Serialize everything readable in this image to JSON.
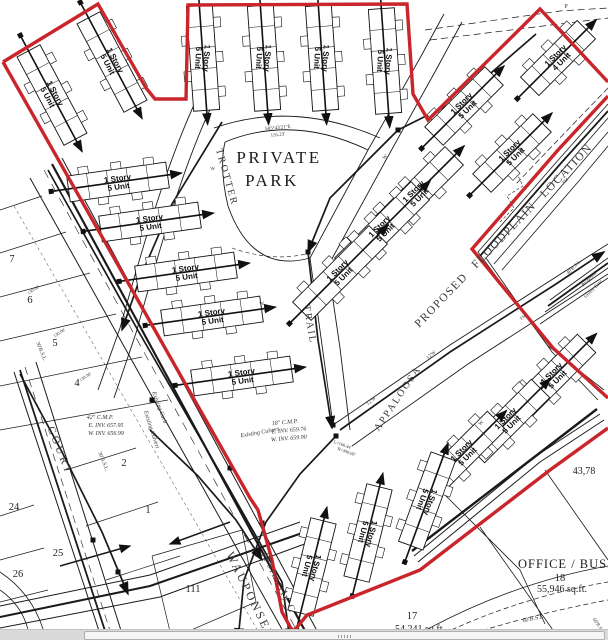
{
  "colors": {
    "boundary_red": "#c9252b",
    "ink": "#1a1a1a"
  },
  "park": {
    "line1": "PRIVATE",
    "line2": "PARK"
  },
  "office": {
    "name": "OFFICE / BUSIN",
    "lot_number": "18",
    "area": "55,946 sq.ft."
  },
  "lot17": {
    "number": "17",
    "area": "54,241 sq.ft."
  },
  "edge_area": "43,78",
  "building_labels": {
    "5": [
      "1 Story",
      "5 Unit"
    ],
    "4": [
      "1 Story",
      "4 Unit"
    ]
  },
  "buildings": [
    {
      "x": 52,
      "y": 95,
      "rot": 62,
      "lrot": 62,
      "len": 100
    },
    {
      "x": 112,
      "y": 62,
      "rot": 62,
      "lrot": 62,
      "len": 100
    },
    {
      "x": 203,
      "y": 58,
      "rot": 86,
      "lrot": 93,
      "len": 105
    },
    {
      "x": 264,
      "y": 58,
      "rot": 86,
      "lrot": 93,
      "len": 105
    },
    {
      "x": 322,
      "y": 58,
      "rot": 86,
      "lrot": 93,
      "len": 105
    },
    {
      "x": 385,
      "y": 61,
      "rot": 86,
      "lrot": 93,
      "len": 105
    },
    {
      "x": 118,
      "y": 182,
      "rot": -8,
      "lrot": -8,
      "len": 100
    },
    {
      "x": 150,
      "y": 222,
      "rot": -8,
      "lrot": -8,
      "len": 100
    },
    {
      "x": 186,
      "y": 272,
      "rot": -8,
      "lrot": -8,
      "len": 100
    },
    {
      "x": 212,
      "y": 316,
      "rot": -8,
      "lrot": -8,
      "len": 100
    },
    {
      "x": 242,
      "y": 376,
      "rot": -8,
      "lrot": -8,
      "len": 100
    },
    {
      "x": 416,
      "y": 194,
      "rot": -45,
      "lrot": -45,
      "len": 108
    },
    {
      "x": 382,
      "y": 229,
      "rot": -45,
      "lrot": -45,
      "len": 108
    },
    {
      "x": 340,
      "y": 273,
      "rot": -45,
      "lrot": -45,
      "len": 108
    },
    {
      "x": 558,
      "y": 58,
      "rot": -45,
      "lrot": -45,
      "len": 80,
      "type": "4"
    },
    {
      "x": 464,
      "y": 106,
      "rot": -45,
      "lrot": -45,
      "len": 85
    },
    {
      "x": 512,
      "y": 153,
      "rot": -45,
      "lrot": -45,
      "len": 85
    },
    {
      "x": 554,
      "y": 376,
      "rot": -45,
      "lrot": -45,
      "len": 92
    },
    {
      "x": 508,
      "y": 421,
      "rot": -45,
      "lrot": -45,
      "len": 92
    },
    {
      "x": 464,
      "y": 453,
      "rot": -45,
      "lrot": -45,
      "len": 92
    },
    {
      "x": 312,
      "y": 567,
      "rot": -76,
      "lrot": 104,
      "len": 95
    },
    {
      "x": 368,
      "y": 533,
      "rot": -76,
      "lrot": 104,
      "len": 95
    },
    {
      "x": 427,
      "y": 501,
      "rot": -70,
      "lrot": 110,
      "len": 95
    }
  ],
  "street_names": [
    {
      "name": "COURT",
      "x": 57,
      "y": 452,
      "rot": 68,
      "size": 11,
      "ls": 3
    },
    {
      "name": "WAUPONSEE",
      "x": 247,
      "y": 597,
      "rot": 64,
      "size": 12,
      "ls": 2.5
    },
    {
      "name": "(Formerly C",
      "x": 276,
      "y": 584,
      "rot": 64,
      "size": 10,
      "ls": 1.5
    },
    {
      "name": "TROTTER",
      "x": 224,
      "y": 178,
      "rot": 74,
      "size": 10,
      "ls": 2
    },
    {
      "name": "TRAIL",
      "x": 307,
      "y": 325,
      "rot": 80,
      "size": 10,
      "ls": 2
    },
    {
      "name": "APPALOOSA",
      "x": 400,
      "y": 400,
      "rot": -56,
      "size": 10,
      "ls": 2
    },
    {
      "name": "PROPOSED FLOODPLAIN LOCATION",
      "x": 506,
      "y": 238,
      "rot": -46,
      "size": 11.5,
      "ls": 1.5,
      "ws": 7
    }
  ],
  "lot_numbers": [
    {
      "n": "7",
      "x": 12,
      "y": 262
    },
    {
      "n": "6",
      "x": 30,
      "y": 303
    },
    {
      "n": "5",
      "x": 55,
      "y": 346
    },
    {
      "n": "4",
      "x": 77,
      "y": 386
    },
    {
      "n": "2",
      "x": 124,
      "y": 466
    },
    {
      "n": "1",
      "x": 148,
      "y": 513
    },
    {
      "n": "24",
      "x": 14,
      "y": 510
    },
    {
      "n": "25",
      "x": 58,
      "y": 556
    },
    {
      "n": "26",
      "x": 18,
      "y": 577
    },
    {
      "n": "111",
      "x": 193,
      "y": 592
    },
    {
      "n": "110",
      "x": 207,
      "y": 638
    }
  ],
  "annotations": [
    {
      "t": "S85°43'21\"E",
      "x": 278,
      "y": 129,
      "rot": -5,
      "s": 5
    },
    {
      "t": "155.23'",
      "x": 278,
      "y": 136,
      "rot": -5,
      "s": 5
    },
    {
      "t": "42\" C.M.P.",
      "x": 100,
      "y": 419,
      "rot": 0,
      "s": 6,
      "i": 1
    },
    {
      "t": "E. INV. 657.95",
      "x": 106,
      "y": 427,
      "rot": 0,
      "s": 6,
      "i": 1
    },
    {
      "t": "W. INV. 656.99",
      "x": 106,
      "y": 435,
      "rot": 0,
      "s": 6,
      "i": 1
    },
    {
      "t": "18\" C.M.P.",
      "x": 285,
      "y": 424,
      "rot": -5,
      "s": 6,
      "i": 1
    },
    {
      "t": "E. INV. 659.76",
      "x": 289,
      "y": 432,
      "rot": -5,
      "s": 6,
      "i": 1
    },
    {
      "t": "W. INV. 659.90",
      "x": 289,
      "y": 440,
      "rot": -5,
      "s": 6,
      "i": 1
    },
    {
      "t": "Existing Culvert",
      "x": 150,
      "y": 430,
      "rot": 72,
      "s": 6,
      "i": 1
    },
    {
      "t": "Existing Culvert",
      "x": 260,
      "y": 434,
      "rot": -10,
      "s": 6,
      "i": 1
    },
    {
      "t": "Existing Curb",
      "x": 158,
      "y": 408,
      "rot": 70,
      "s": 6,
      "i": 1
    },
    {
      "t": "30'B.S.L.",
      "x": 40,
      "y": 352,
      "rot": 68,
      "s": 5.5
    },
    {
      "t": "30'B.S.L.",
      "x": 102,
      "y": 462,
      "rot": 68,
      "s": 5.5
    },
    {
      "t": "40'B.S.L.",
      "x": 575,
      "y": 268,
      "rot": -45,
      "s": 5
    },
    {
      "t": "60'B.S.L.",
      "x": 534,
      "y": 620,
      "rot": -12,
      "s": 6
    },
    {
      "t": "60'B.S.L.",
      "x": 598,
      "y": 627,
      "rot": 55,
      "s": 5
    },
    {
      "t": "Proposed",
      "x": 590,
      "y": 280,
      "rot": -45,
      "s": 5
    },
    {
      "t": "Utility Ease",
      "x": 594,
      "y": 290,
      "rot": -45,
      "s": 5
    },
    {
      "t": "130.00'",
      "x": 34,
      "y": 291,
      "rot": -33,
      "s": 4.5
    },
    {
      "t": "130.00'",
      "x": 60,
      "y": 334,
      "rot": -33,
      "s": 4.5
    },
    {
      "t": "130.00'",
      "x": 86,
      "y": 378,
      "rot": -33,
      "s": 4.5
    },
    {
      "t": "L=168.44'",
      "x": 342,
      "y": 446,
      "rot": 20,
      "s": 4.5
    },
    {
      "t": "R=490.00'",
      "x": 346,
      "y": 453,
      "rot": 20,
      "s": 4.5
    },
    {
      "t": "12'W",
      "x": 432,
      "y": 356,
      "rot": -40,
      "s": 5
    },
    {
      "t": "12'W",
      "x": 372,
      "y": 402,
      "rot": -40,
      "s": 5
    },
    {
      "t": "FM",
      "x": 524,
      "y": 318,
      "rot": -40,
      "s": 4.5
    },
    {
      "t": "FM",
      "x": 566,
      "y": 182,
      "rot": -40,
      "s": 4.5
    },
    {
      "t": "W",
      "x": 213,
      "y": 170,
      "rot": -8,
      "s": 5
    },
    {
      "t": "W",
      "x": 262,
      "y": 305,
      "rot": -8,
      "s": 5
    },
    {
      "t": "W",
      "x": 386,
      "y": 158,
      "rot": -45,
      "s": 5
    },
    {
      "t": "W",
      "x": 482,
      "y": 424,
      "rot": -45,
      "s": 5
    },
    {
      "t": "P",
      "x": 566,
      "y": 8,
      "rot": 0,
      "s": 6
    }
  ]
}
